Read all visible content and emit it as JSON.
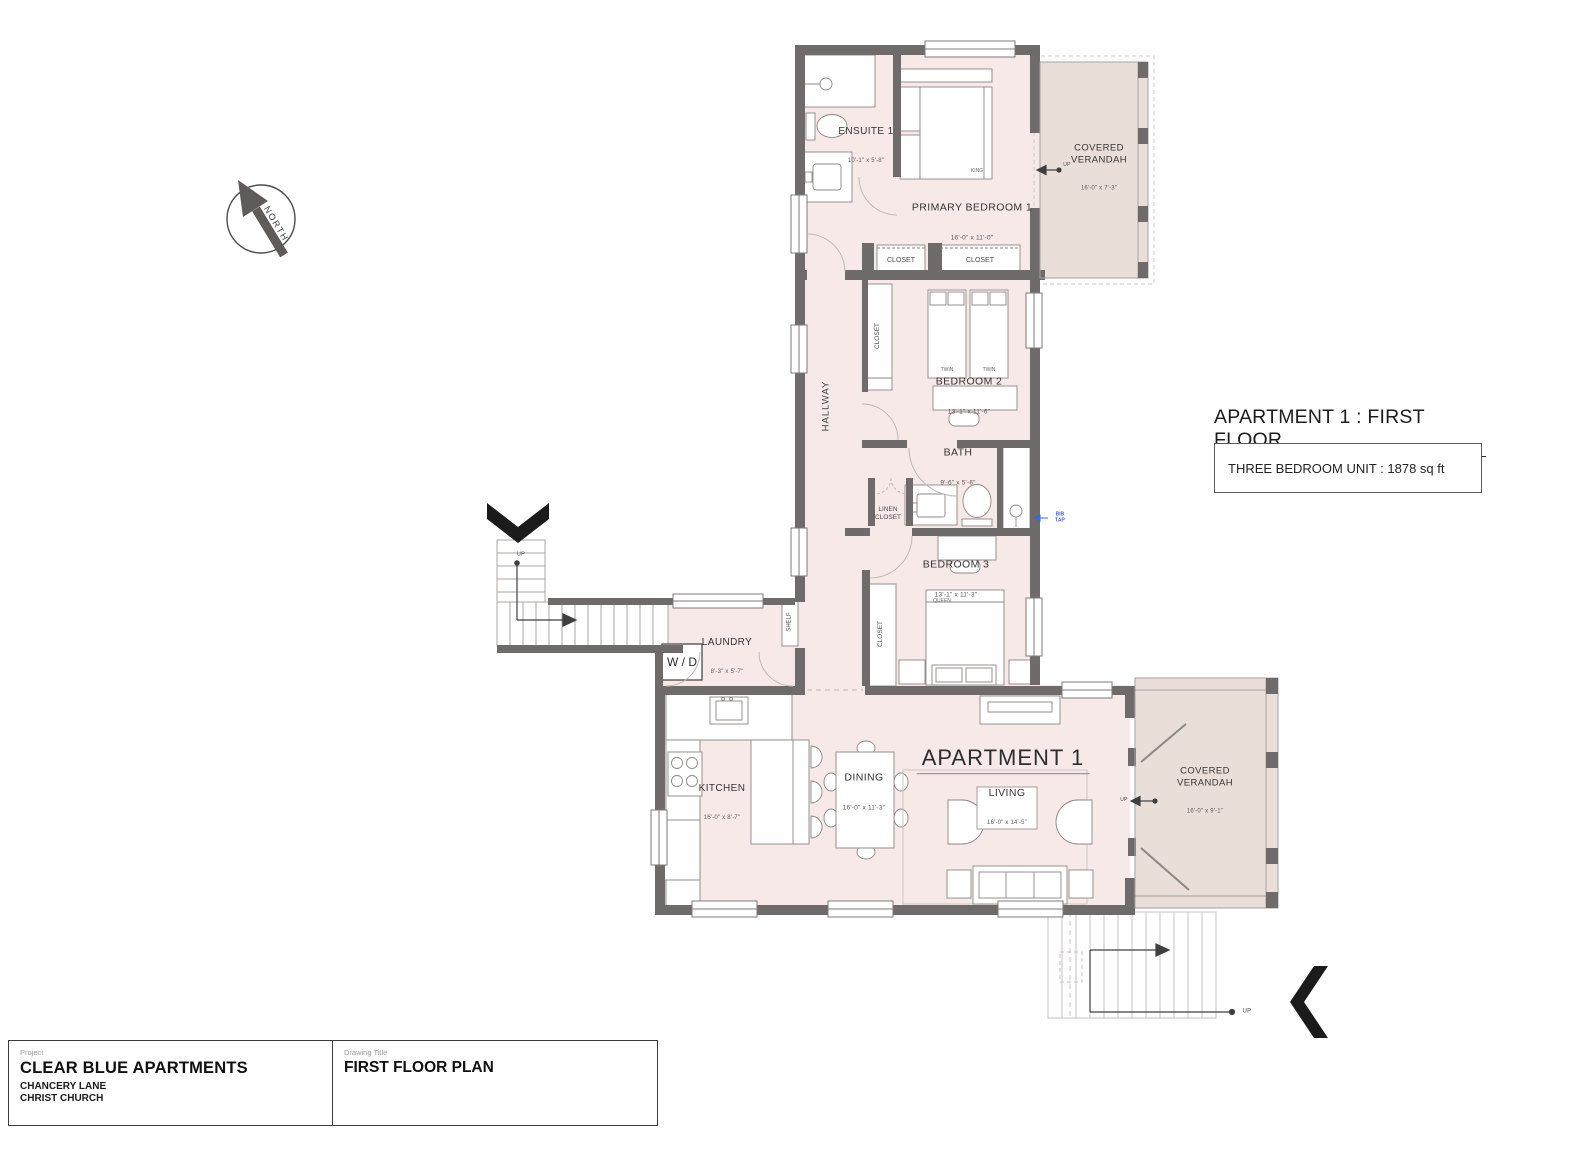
{
  "title": {
    "heading": "APARTMENT 1 : FIRST FLOOR",
    "unit_info": "THREE BEDROOM UNIT : 1878 sq ft"
  },
  "compass": {
    "label": "NORTH"
  },
  "rooms": {
    "ensuite": {
      "name": "ENSUITE 1",
      "dims": "10'-1\" x 5'-8\""
    },
    "primary_bedroom": {
      "name": "PRIMARY BEDROOM 1",
      "dims": "16'-0\" x 11'-0\""
    },
    "closet": {
      "name": "CLOSET"
    },
    "verandah_top": {
      "name": "COVERED\nVERANDAH",
      "dims": "16'-0\" x 7'-3\""
    },
    "hallway": {
      "name": "HALLWAY"
    },
    "bedroom2": {
      "name": "BEDROOM 2",
      "dims": "13'-1\" x 11'-6\""
    },
    "bath": {
      "name": "BATH",
      "dims": "9'-6\" x 5'-6\""
    },
    "linen_closet": {
      "name": "LINEN\nCLOSET"
    },
    "bedroom3": {
      "name": "BEDROOM 3",
      "dims": "13'-1\" x 11'-3\""
    },
    "shelf": {
      "name": "SHELF"
    },
    "laundry": {
      "name": "LAUNDRY",
      "dims": "8'-3\" x 5'-7\""
    },
    "washer_dryer": {
      "name": "W / D"
    },
    "kitchen": {
      "name": "KITCHEN",
      "dims": "16'-0\" x 8'-7\""
    },
    "dining": {
      "name": "DINING",
      "dims": "16'-0\" x 11'-3\""
    },
    "apartment": {
      "name": "APARTMENT 1"
    },
    "living": {
      "name": "LIVING",
      "dims": "16'-0\" x 14'-5\""
    },
    "verandah_bottom": {
      "name": "COVERED\nVERANDAH",
      "dims": "16'-0\" x 9'-1\""
    }
  },
  "furniture_labels": {
    "king": "KING",
    "twin": "TWIN",
    "queen": "QUEEN"
  },
  "annotations": {
    "up": "UP",
    "bib_tap": "BIB\nTAP"
  },
  "title_block": {
    "project_label": "Project",
    "project_name": "CLEAR BLUE APARTMENTS",
    "address_line1": "CHANCERY LANE",
    "address_line2": "CHRIST CHURCH",
    "drawing_title_label": "Drawing Title",
    "drawing_title": "FIRST FLOOR PLAN"
  },
  "colors": {
    "wall": "#6f6b6a",
    "room_fill": "#f7e9e8",
    "verandah_fill": "#eadfd8",
    "annotation_blue": "#3a67d9"
  }
}
